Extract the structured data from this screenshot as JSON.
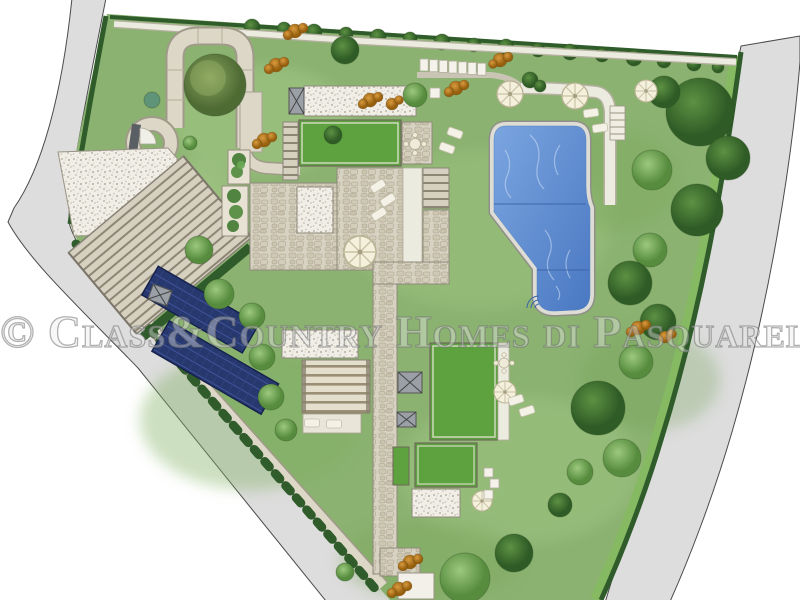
{
  "watermark": {
    "text": "© Class&Country Homes di Pasquarelli Immo",
    "color_hex": "#8c8c8c"
  },
  "plan": {
    "type": "residential-garden-site-plan",
    "colors": {
      "background": "#ffffff",
      "road": "#dddddd",
      "road_edge": "#4a4a4a",
      "lawn": "#8bb271",
      "hedge": "#2f5c2a",
      "boundary_band": "#86ba62",
      "stone_path": "#ddd7c7",
      "cobble": "#d8d2c2",
      "white_gravel": "#f0eee6",
      "green_roof": "#5da23f",
      "pool_water": "#5d8ed6",
      "pool_coping": "#ddddd6",
      "solar_panel": "#26386d",
      "shrub_orange": "#c07a1e",
      "parasol": "#f4f0dc"
    },
    "features": [
      {
        "name": "left-road"
      },
      {
        "name": "right-road"
      },
      {
        "name": "property-lawn"
      },
      {
        "name": "perimeter-hedge"
      },
      {
        "name": "winding-driveway"
      },
      {
        "name": "turning-circle"
      },
      {
        "name": "parking-terrace"
      },
      {
        "name": "grand-staircase"
      },
      {
        "name": "solar-panels",
        "count": 2
      },
      {
        "name": "villa-buildings"
      },
      {
        "name": "green-roofs",
        "count": 4
      },
      {
        "name": "stone-terraces"
      },
      {
        "name": "pergola"
      },
      {
        "name": "swimming-pool"
      },
      {
        "name": "pool-steps"
      },
      {
        "name": "pool-ladder"
      },
      {
        "name": "parasols",
        "count": 6
      },
      {
        "name": "sun-loungers"
      },
      {
        "name": "parking-bays-row",
        "count": 7
      },
      {
        "name": "garden-paths"
      },
      {
        "name": "trees"
      },
      {
        "name": "orange-shrubs"
      },
      {
        "name": "gate-platform"
      }
    ]
  }
}
